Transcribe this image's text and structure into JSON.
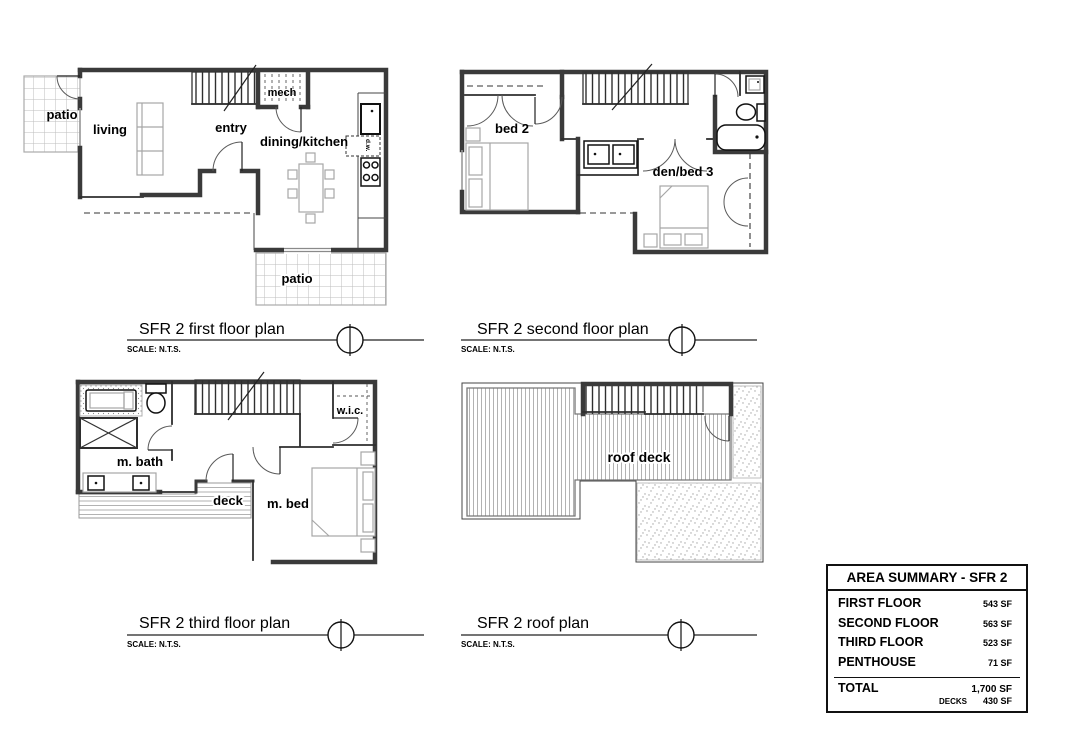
{
  "colors": {
    "paper": "#ffffff",
    "wall": "#3a3a3a",
    "thin_line": "#444444",
    "furniture": "#a6a6a6",
    "hatch": "#9e9e9e",
    "text": "#000000"
  },
  "plans": {
    "first": {
      "title": "SFR 2 first floor plan",
      "scale_note": "SCALE: N.T.S.",
      "labels": {
        "patio_left": "patio",
        "living": "living",
        "entry": "entry",
        "dining_kitchen": "dining/kitchen",
        "mech": "mech",
        "dw": "d.w.",
        "patio_bottom": "patio"
      }
    },
    "second": {
      "title": "SFR 2 second floor plan",
      "scale_note": "SCALE: N.T.S.",
      "labels": {
        "bed2": "bed 2",
        "den_bed3": "den/bed 3"
      }
    },
    "third": {
      "title": "SFR 2 third floor plan",
      "scale_note": "SCALE: N.T.S.",
      "labels": {
        "m_bath": "m. bath",
        "deck": "deck",
        "m_bed": "m. bed",
        "wic": "w.i.c."
      }
    },
    "roof": {
      "title": "SFR 2 roof plan",
      "scale_note": "SCALE: N.T.S.",
      "labels": {
        "roof_deck": "roof deck"
      }
    }
  },
  "area_summary": {
    "title": "AREA SUMMARY - SFR 2",
    "rows": [
      {
        "label": "FIRST FLOOR",
        "value": "543 SF"
      },
      {
        "label": "SECOND FLOOR",
        "value": "563 SF"
      },
      {
        "label": "THIRD FLOOR",
        "value": "523 SF"
      },
      {
        "label": "PENTHOUSE",
        "value": "71 SF"
      }
    ],
    "total_label": "TOTAL",
    "total_value": "1,700 SF",
    "decks_label": "DECKS",
    "decks_value": "430 SF"
  }
}
